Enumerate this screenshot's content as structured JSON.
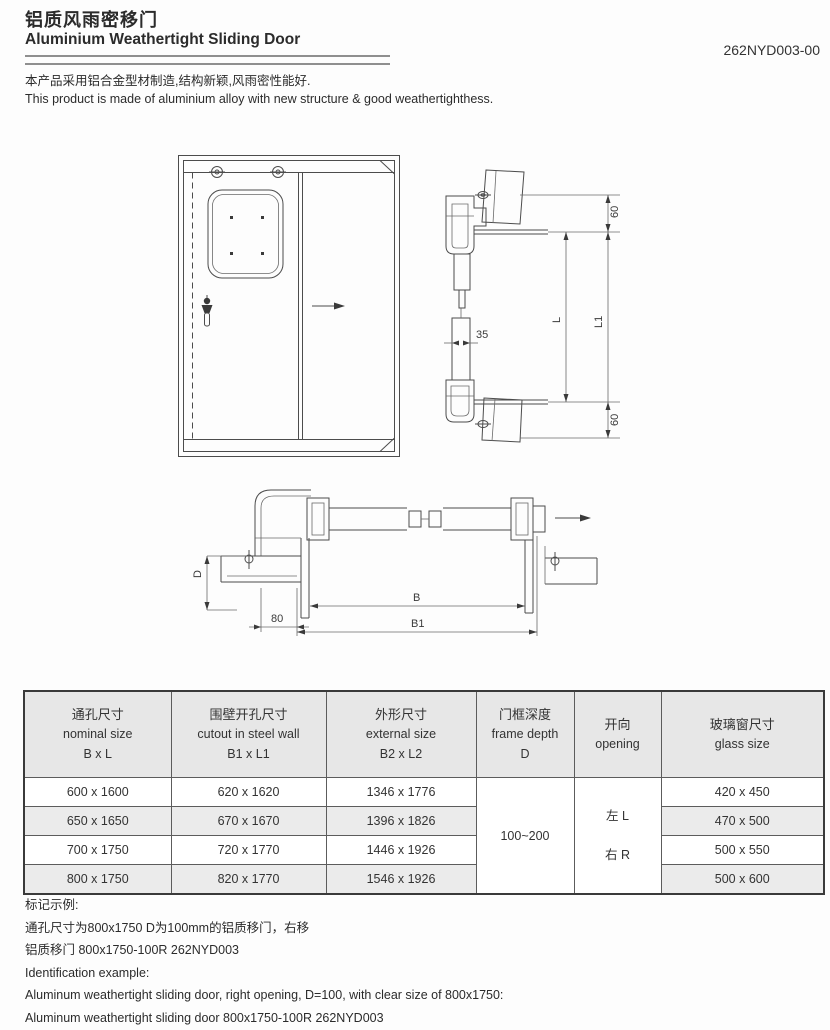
{
  "header": {
    "title_zh": "铝质风雨密移门",
    "title_en": "Aluminium Weathertight Sliding Door",
    "part_number": "262NYD003-00",
    "description_zh": "本产品采用铝合金型材制造,结构新颖,风雨密性能好.",
    "description_en": "This product is made of aluminium alloy with new structure & good weathertighthess."
  },
  "drawings": {
    "vertical_section": {
      "dim_top": "60",
      "dim_l": "L",
      "dim_l1": "L1",
      "dim_bottom": "60",
      "dim_panel": "35"
    },
    "horizontal_section": {
      "dim_depth": "D",
      "dim_80": "80",
      "dim_b": "B",
      "dim_b1": "B1"
    }
  },
  "table": {
    "columns": [
      {
        "zh": "通孔尺寸",
        "en": "nominal size",
        "sub": "B x L"
      },
      {
        "zh": "围壁开孔尺寸",
        "en": "cutout in steel wall",
        "sub": "B1 x L1"
      },
      {
        "zh": "外形尺寸",
        "en": "external size",
        "sub": "B2 x L2"
      },
      {
        "zh": "门框深度",
        "en": "frame depth",
        "sub": "D"
      },
      {
        "zh": "开向",
        "en": "opening",
        "sub": ""
      },
      {
        "zh": "玻璃窗尺寸",
        "en": "glass size",
        "sub": ""
      }
    ],
    "rows": [
      {
        "nominal": "600 x 1600",
        "cutout": "620 x 1620",
        "external": "1346 x 1776",
        "glass": "420 x 450"
      },
      {
        "nominal": "650 x 1650",
        "cutout": "670 x 1670",
        "external": "1396 x 1826",
        "glass": "470 x 500"
      },
      {
        "nominal": "700 x 1750",
        "cutout": "720 x 1770",
        "external": "1446 x 1926",
        "glass": "500 x 550"
      },
      {
        "nominal": "800 x 1750",
        "cutout": "820 x 1770",
        "external": "1546 x 1926",
        "glass": "500 x 600"
      }
    ],
    "frame_depth": "100~200",
    "opening_left": "左 L",
    "opening_right": "右 R"
  },
  "footer": {
    "mark_title_zh": "标记示例:",
    "mark_line1_zh": "通孔尺寸为800x1750 D为100mm的铝质移门，右移",
    "mark_line2_zh": "铝质移门 800x1750-100R 262NYD003",
    "mark_title_en": "Identification example:",
    "mark_line1_en": "Aluminum weathertight sliding door, right opening, D=100, with clear size of 800x1750:",
    "mark_line2_en": "Aluminum weathertight sliding door 800x1750-100R 262NYD003"
  }
}
